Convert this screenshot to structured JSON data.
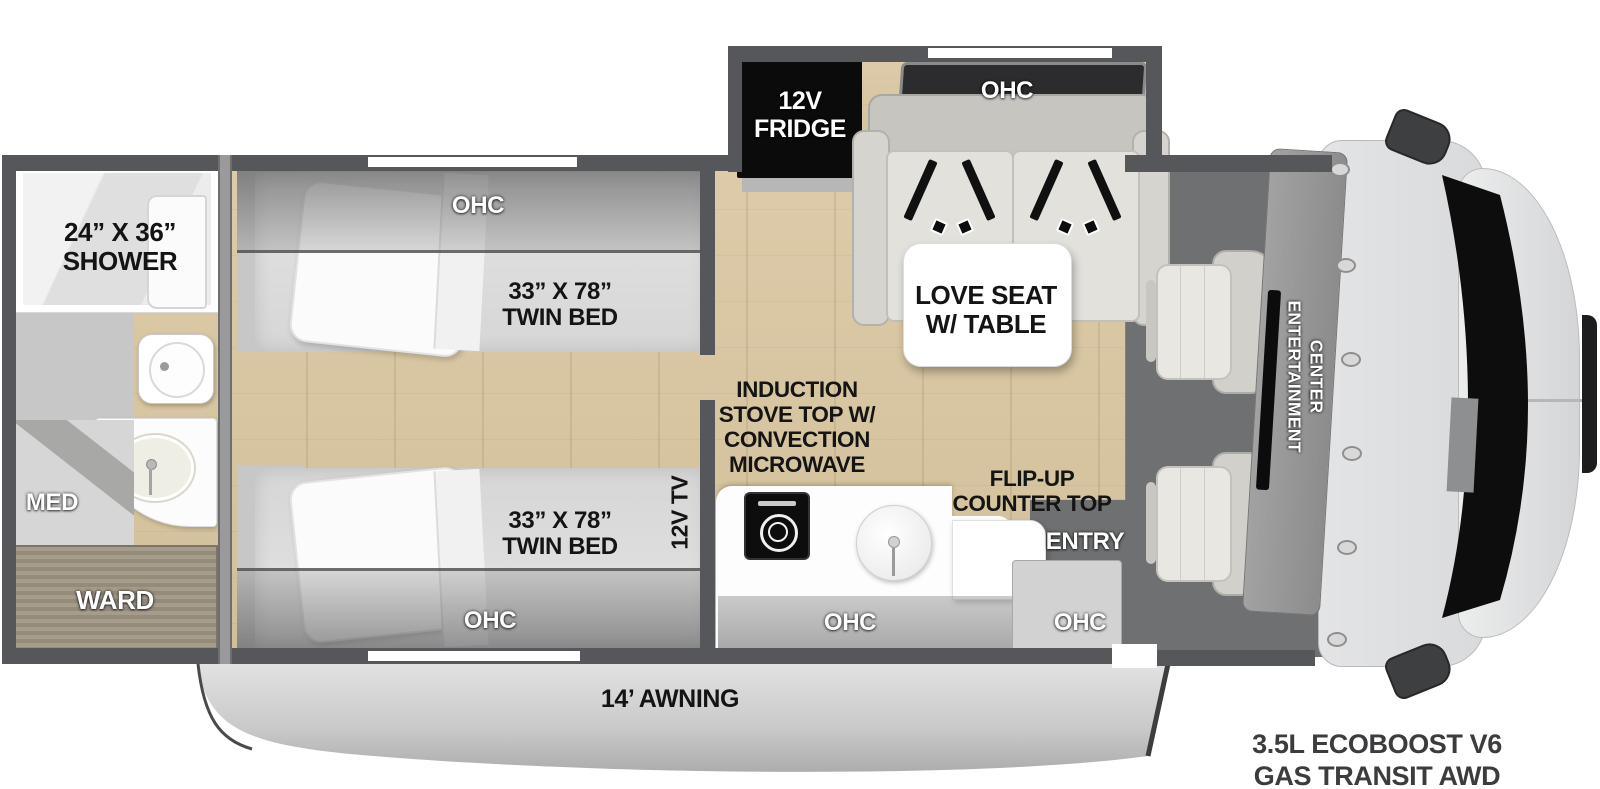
{
  "title": "RV floorplan - twin bed class C motorhome",
  "colors": {
    "wall": "#56575a",
    "wood_floor": "#d8c6a2",
    "cab_floor": "#6f7072",
    "fridge": "#0b0b0b",
    "awning": "#cfcfcf",
    "label_black": "#141414",
    "label_white": "#ffffff"
  },
  "floorplan": {
    "bathroom": {
      "shower_label": [
        "24” X 36”",
        "SHOWER"
      ],
      "med_label": "MED",
      "ward_label": "WARD"
    },
    "bedroom": {
      "ohc_top_label": "OHC",
      "ohc_bottom_label": "OHC",
      "bed_top_label": [
        "33” X 78”",
        "TWIN BED"
      ],
      "bed_bottom_label": [
        "33” X 78”",
        "TWIN BED"
      ],
      "tv_label": "12V TV"
    },
    "kitchen": {
      "stove_label": [
        "INDUCTION",
        "STOVE TOP W/",
        "CONVECTION",
        "MICROWAVE"
      ],
      "flip_up_label": [
        "FLIP-UP",
        "COUNTER TOP"
      ],
      "ohc_label": "OHC"
    },
    "living": {
      "fridge_label": [
        "12V",
        "FRIDGE"
      ],
      "ohc_label": "OHC",
      "loveseat_label": [
        "LOVE SEAT",
        "W/ TABLE"
      ]
    },
    "entry": {
      "entry_label": "ENTRY",
      "ohc_label": "OHC"
    },
    "cab": {
      "entertainment_label": [
        "ENTERTAINMENT",
        "CENTER"
      ]
    },
    "exterior": {
      "awning_label": "14’ AWNING",
      "engine_label": [
        "3.5L ECOBOOST V6",
        "GAS TRANSIT AWD"
      ]
    }
  }
}
